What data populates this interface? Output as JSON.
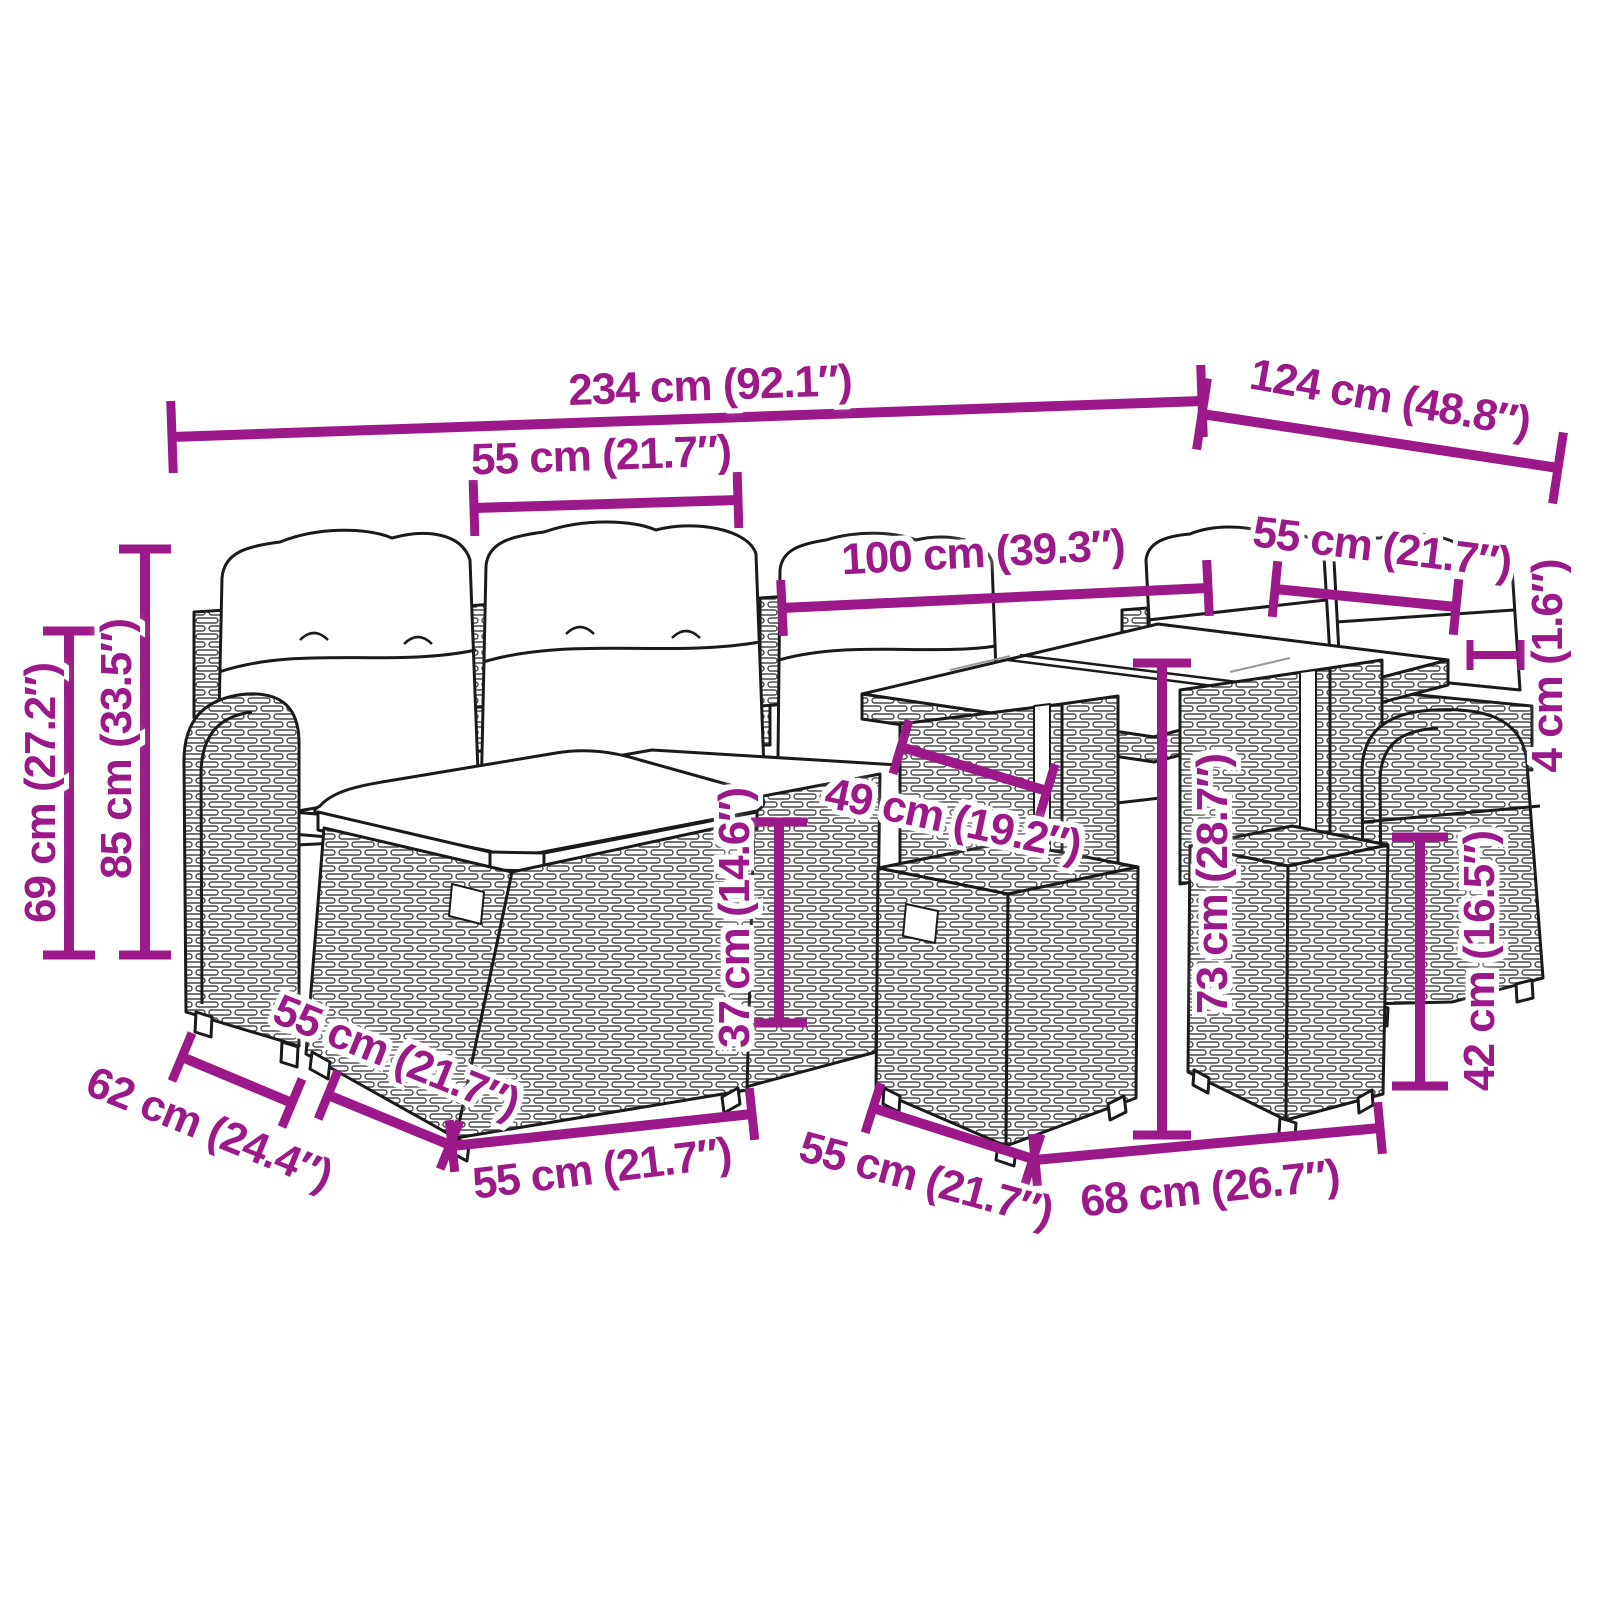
{
  "diagram": {
    "type": "product-dimension-diagram",
    "subject": "poly rattan garden lounge set with cushions, glass-top table and ottomans",
    "background_color": "#ffffff",
    "line_art_color": "#1a1a1a",
    "accent_color": "#9B1989",
    "unit_primary": "cm",
    "unit_secondary": "in",
    "dimensions": [
      {
        "id": "total-width",
        "label": "234 cm (92.1″)",
        "value_cm": 234,
        "value_in": 92.1,
        "line": [
          172,
          437,
          1202,
          401
        ],
        "tick": 72,
        "lx": 710,
        "ly": 386,
        "rot": -2
      },
      {
        "id": "total-depth-right",
        "label": "124 cm (48.8″)",
        "value_cm": 124,
        "value_in": 48.8,
        "line": [
          1202,
          414,
          1558,
          468
        ],
        "tick": 72,
        "lx": 1390,
        "ly": 399,
        "rot": 10
      },
      {
        "id": "seat-width",
        "label": "55 cm (21.7″)",
        "value_cm": 55,
        "value_in": 21.7,
        "line": [
          474,
          508,
          738,
          500
        ],
        "tick": 56,
        "lx": 601,
        "ly": 456,
        "rot": -2
      },
      {
        "id": "table-length",
        "label": "100 cm (39.3″)",
        "value_cm": 100,
        "value_in": 39.3,
        "line": [
          782,
          608,
          1208,
          588
        ],
        "tick": 56,
        "lx": 983,
        "ly": 553,
        "rot": -3
      },
      {
        "id": "table-width",
        "label": "55 cm (21.7″)",
        "value_cm": 55,
        "value_in": 21.7,
        "line": [
          1275,
          589,
          1456,
          607
        ],
        "tick": 56,
        "lx": 1382,
        "ly": 548,
        "rot": 7
      },
      {
        "id": "tabletop-thickness",
        "label": "4 cm (1.6″)",
        "value_cm": 4,
        "value_in": 1.6,
        "line": [
          1470,
          655,
          1521,
          655
        ],
        "tick": 30,
        "lw": 8,
        "tw": 7,
        "lx": 1548,
        "ly": 666,
        "rot": -90
      },
      {
        "id": "back-height",
        "label": "85 cm (33.5″)",
        "value_cm": 85,
        "value_in": 33.5,
        "line": [
          145,
          549,
          145,
          955
        ],
        "tick": 52,
        "lx": 117,
        "ly": 749,
        "rot": -90
      },
      {
        "id": "arm-height",
        "label": "69 cm (27.2″)",
        "value_cm": 69,
        "value_in": 27.2,
        "line": [
          69,
          631,
          69,
          955
        ],
        "tick": 52,
        "lx": 41,
        "ly": 793,
        "rot": -90
      },
      {
        "id": "sofa-depth",
        "label": "62 cm (24.4″)",
        "value_cm": 62,
        "value_in": 24.4,
        "line": [
          182,
          1057,
          292,
          1103
        ],
        "tick": 52,
        "lx": 209,
        "ly": 1129,
        "rot": 22
      },
      {
        "id": "ottoman-depth-left",
        "label": "55 cm (21.7″)",
        "value_cm": 55,
        "value_in": 21.7,
        "line": [
          328,
          1095,
          450,
          1145
        ],
        "tick": 52,
        "lx": 396,
        "ly": 1057,
        "rot": 22
      },
      {
        "id": "ottoman-width-left",
        "label": "55 cm (21.7″)",
        "value_cm": 55,
        "value_in": 21.7,
        "line": [
          452,
          1146,
          752,
          1114
        ],
        "tick": 52,
        "lx": 602,
        "ly": 1169,
        "rot": -7
      },
      {
        "id": "ottoman-depth-right",
        "label": "55 cm (21.7″)",
        "value_cm": 55,
        "value_in": 21.7,
        "line": [
          873,
          1108,
          1033,
          1159
        ],
        "tick": 52,
        "lx": 926,
        "ly": 1180,
        "rot": 15
      },
      {
        "id": "table-base-width",
        "label": "68 cm (26.7″)",
        "value_cm": 68,
        "value_in": 26.7,
        "line": [
          1035,
          1160,
          1380,
          1128
        ],
        "tick": 52,
        "lx": 1210,
        "ly": 1189,
        "rot": -6
      },
      {
        "id": "ottoman-height",
        "label": "42 cm (16.5″)",
        "value_cm": 42,
        "value_in": 16.5,
        "line": [
          1420,
          837,
          1420,
          1086
        ],
        "tick": 56,
        "lx": 1480,
        "ly": 961,
        "rot": -90
      },
      {
        "id": "table-height",
        "label": "73 cm (28.7″)",
        "value_cm": 73,
        "value_in": 28.7,
        "line": [
          1162,
          663,
          1162,
          1135
        ],
        "tick": 58,
        "lx": 1213,
        "ly": 884,
        "rot": -90
      },
      {
        "id": "seat-height",
        "label": "37 cm (14.6″)",
        "value_cm": 37,
        "value_in": 14.6,
        "line": [
          779,
          822,
          779,
          1023
        ],
        "tick": 56,
        "lx": 735,
        "ly": 918,
        "rot": -90
      },
      {
        "id": "pedestal-width",
        "label": "49 cm (19.2″)",
        "value_cm": 49,
        "value_in": 19.2,
        "line": [
          901,
          747,
          1047,
          791
        ],
        "tick": 56,
        "lx": 953,
        "ly": 820,
        "rot": 12
      }
    ]
  }
}
